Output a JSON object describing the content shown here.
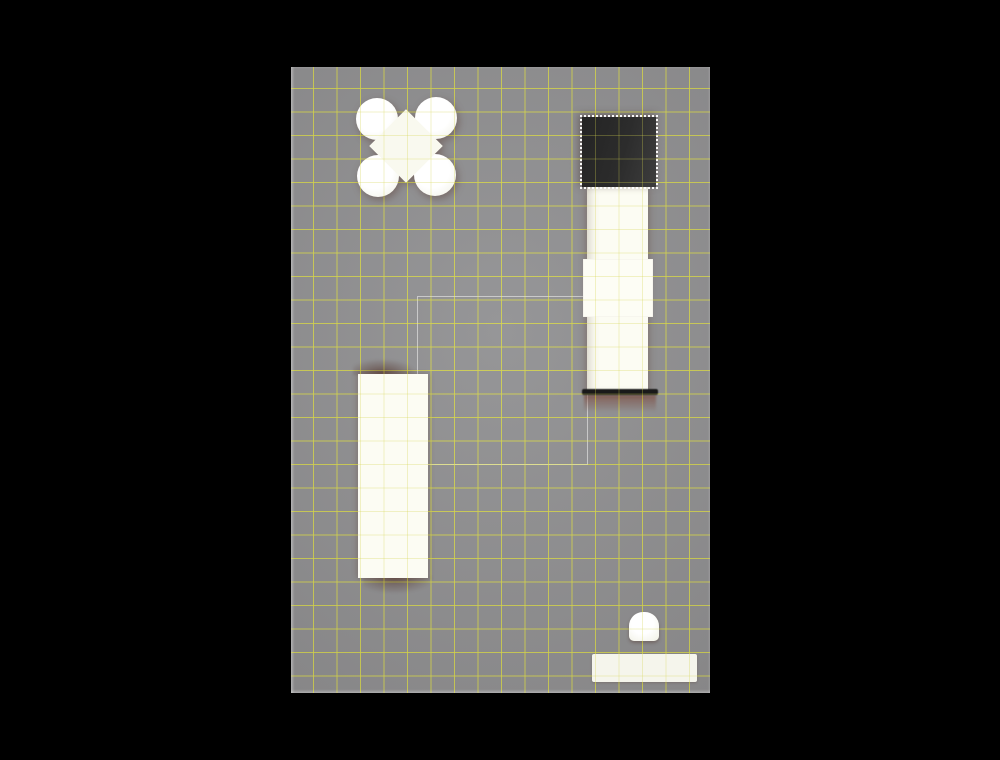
{
  "scene": {
    "view": "top-down orthographic view of a 3D scene",
    "background_color": "#000000",
    "floor": {
      "color": "#8e8e90",
      "grid_line_color": "#d2d24a",
      "grid_spacing_px": 23.5,
      "rect": {
        "left": 291,
        "top": 67,
        "width": 419,
        "height": 626
      },
      "edge_highlight": "light gray on left and bottom edges"
    },
    "selection": {
      "style": "white dotted marquee outline",
      "selected_object": "dark-cube"
    },
    "objects": [
      {
        "id": "sphere-cluster",
        "shape": "four overlapping white spheres joined by a center block (X / flower footprint)",
        "color": "#f9f9ef",
        "rect": {
          "left": 356,
          "top": 96,
          "width": 101,
          "height": 101
        }
      },
      {
        "id": "dark-cube",
        "shape": "cube top face",
        "color": "#2c2c2c",
        "selected": true,
        "rect": {
          "left": 582,
          "top": 115,
          "width": 78,
          "height": 74
        }
      },
      {
        "id": "tall-column-right",
        "shape": "tall rectangular box with wider collar segment and dark base edge",
        "color": "#fcfcf3",
        "rect": {
          "left": 587,
          "top": 187,
          "width": 61,
          "height": 203
        },
        "collar_rect": {
          "left": 583,
          "top": 259,
          "width": 70,
          "height": 58
        },
        "base_edge_color": "#191919",
        "contact_shadow_color": "reddish-brown"
      },
      {
        "id": "tall-column-left",
        "shape": "tall rectangular box with contact shadows above and below",
        "color": "#fcfcf3",
        "rect": {
          "left": 358,
          "top": 374,
          "width": 70,
          "height": 204
        }
      },
      {
        "id": "room-outline",
        "shape": "thin rectangle wireframe on floor",
        "color": "rgba(252,252,250,0.52)",
        "rect": {
          "left": 417,
          "top": 296,
          "width": 169,
          "height": 167
        }
      },
      {
        "id": "stool",
        "shape": "small rounded cylinder with flattened bottom edge",
        "color": "#f6f6ec",
        "rect": {
          "left": 629,
          "top": 612,
          "width": 30,
          "height": 29
        }
      },
      {
        "id": "low-bar",
        "shape": "low wide rectangular slab",
        "color": "#f5f5ec",
        "rect": {
          "left": 592,
          "top": 654,
          "width": 105,
          "height": 28
        }
      }
    ]
  }
}
